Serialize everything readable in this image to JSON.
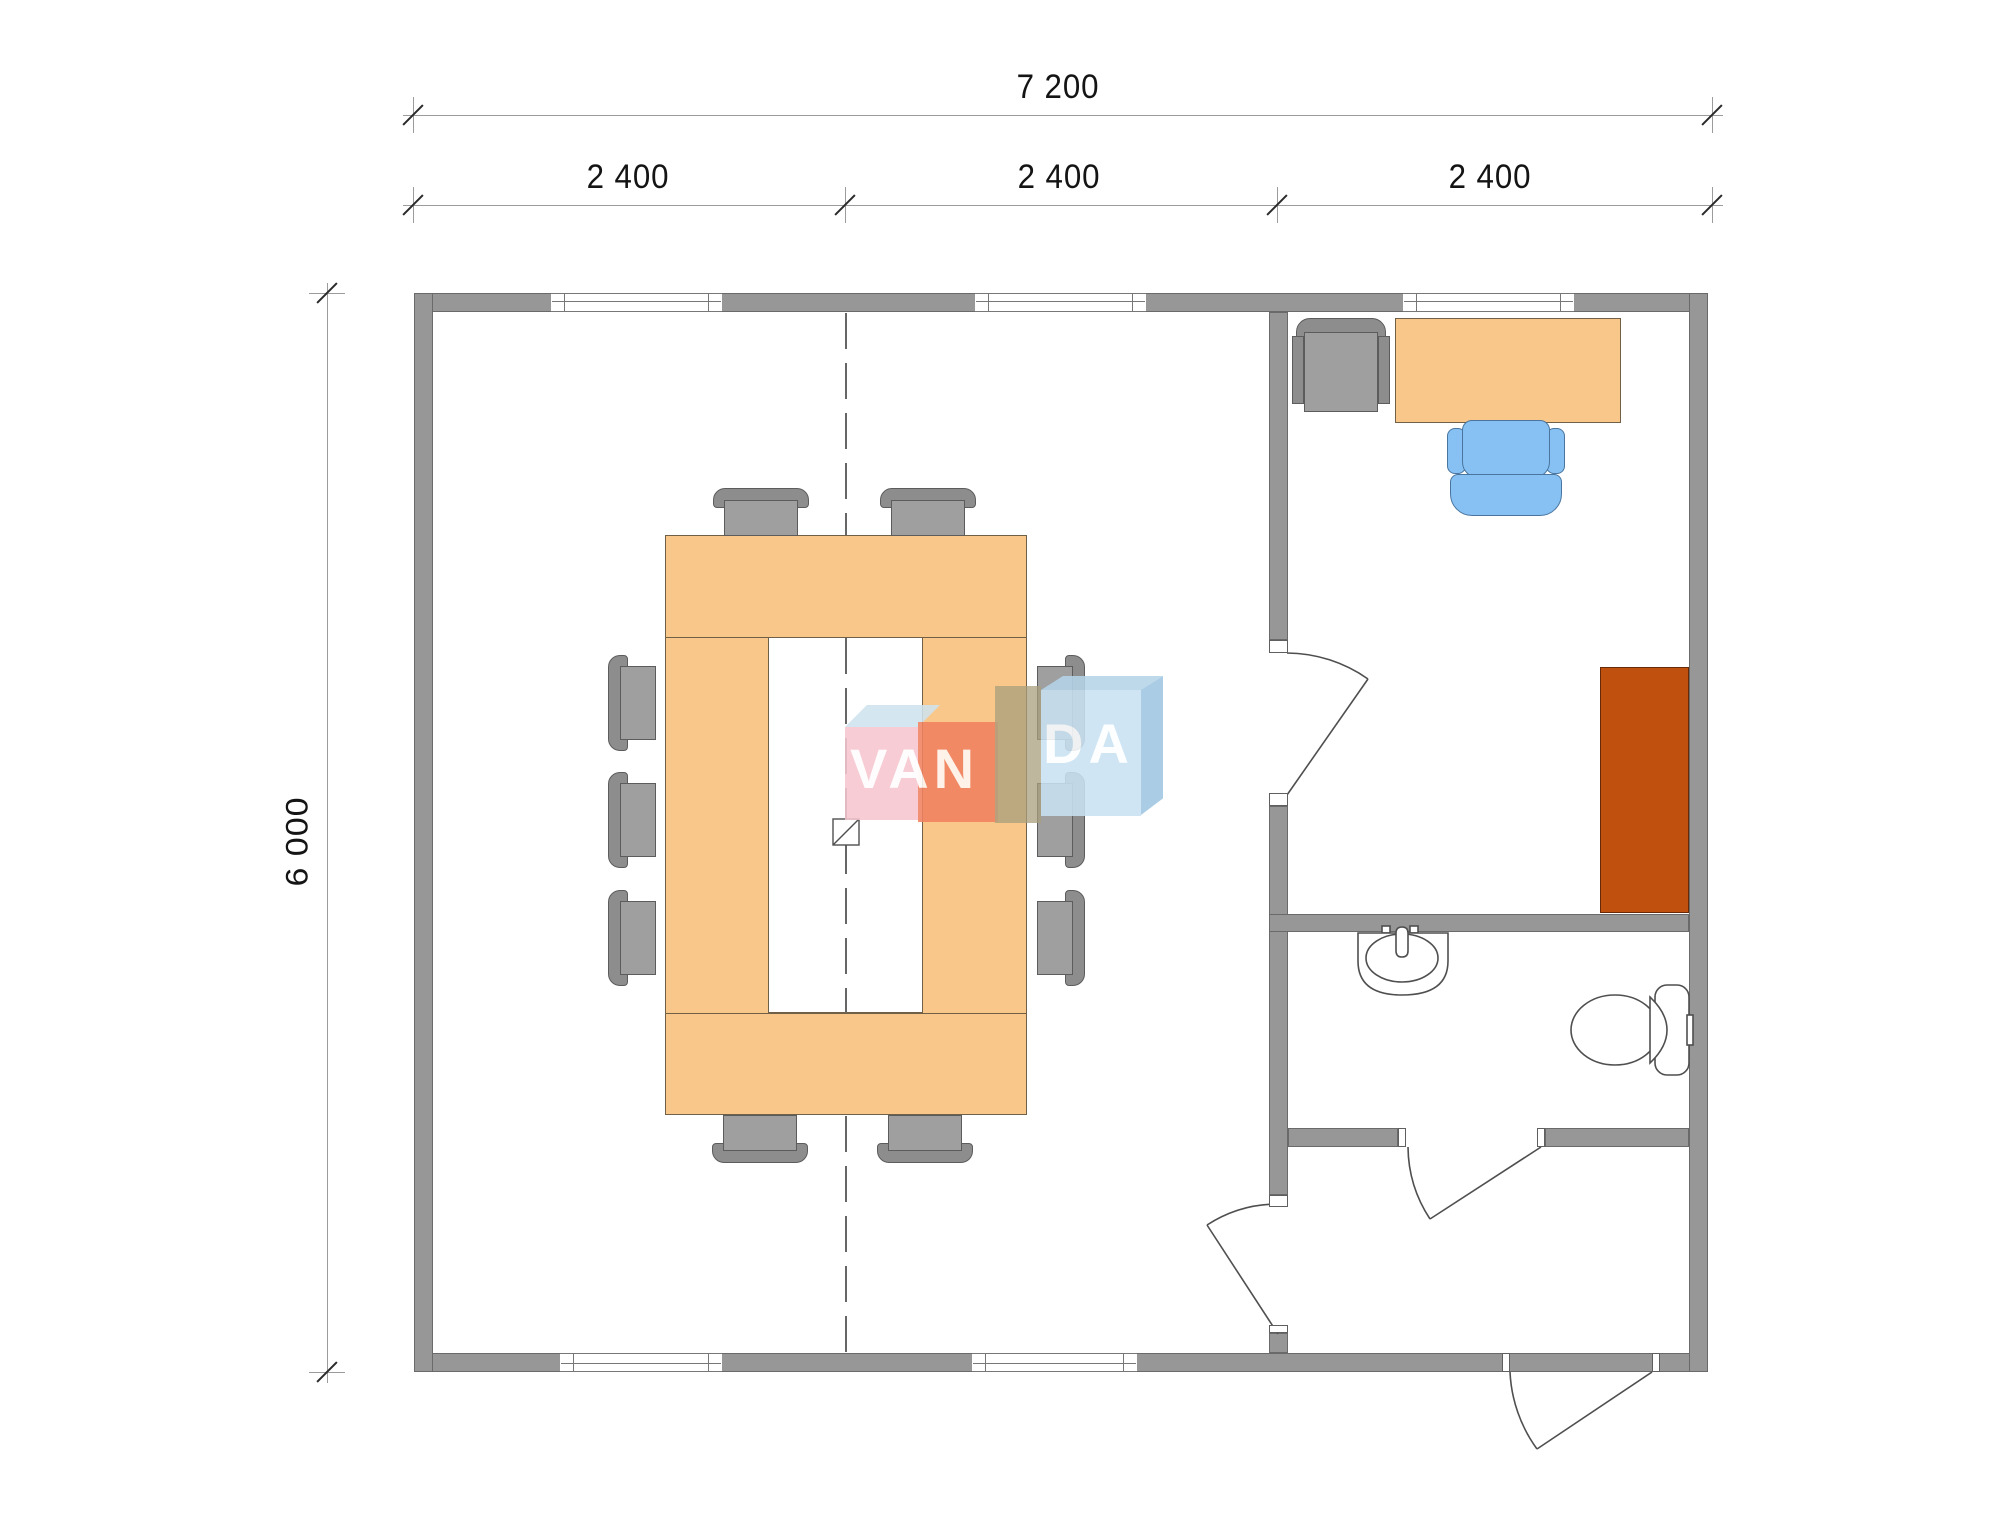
{
  "drawing": {
    "type": "floor-plan",
    "dimensions": {
      "total_width": "7 200",
      "modules": [
        "2 400",
        "2 400",
        "2 400"
      ],
      "total_height": "6 000"
    },
    "watermark": {
      "full": "VANDA",
      "van": "VAN",
      "da": "DA"
    },
    "colors": {
      "wall": "#979797",
      "furniture_wood": "#f9c78a",
      "cabinet": "#c0500d",
      "chair_gray": "#9f9f9f",
      "office_chair_blue": "#87c1f3",
      "watermark_pink": "#f6c6cf",
      "watermark_salmon": "#f08160",
      "watermark_blue": "#c9e2f2"
    },
    "rooms": {
      "meeting_room": {
        "furniture": [
          "conference-table-ring",
          "chairs x10"
        ]
      },
      "office": {
        "furniture": [
          "desk",
          "office-chair",
          "armchair",
          "cabinet"
        ]
      },
      "bathroom": {
        "fixtures": [
          "sink",
          "toilet"
        ]
      },
      "hall": {
        "doors": [
          "entrance-door",
          "bathroom-door",
          "meeting-room-door",
          "office-door"
        ]
      }
    }
  }
}
